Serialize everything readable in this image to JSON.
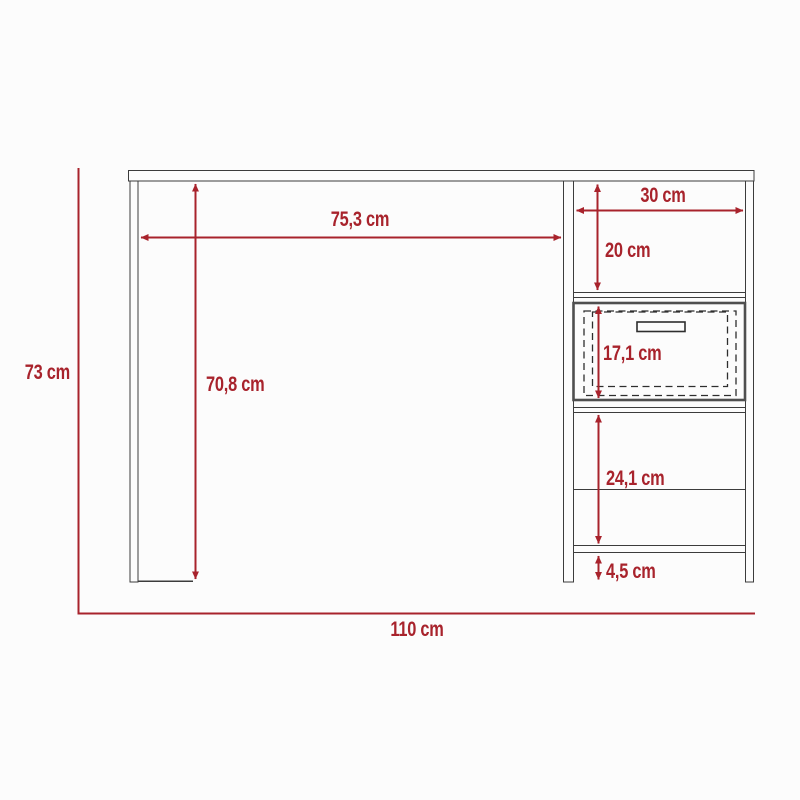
{
  "diagram": {
    "type": "furniture-dimension-drawing",
    "subject": "writing desk with side pedestal, open shelves and one drawer",
    "unit": "cm"
  },
  "colors": {
    "dimension_red": "#a8232c",
    "structure_line": "#3c3c3c",
    "drawer_border": "#4f4f4f",
    "background": "#fcfcfc"
  },
  "dimensions": {
    "overall_height": {
      "label": "73 cm",
      "value": 73
    },
    "overall_width": {
      "label": "110 cm",
      "value": 110
    },
    "worktop_clear_width": {
      "label": "75,3 cm",
      "value": 75.3
    },
    "under_desk_height": {
      "label": "70,8 cm",
      "value": 70.8
    },
    "pedestal_width": {
      "label": "30 cm",
      "value": 30
    },
    "top_compartment_height": {
      "label": "20 cm",
      "value": 20
    },
    "drawer_height": {
      "label": "17,1 cm",
      "value": 17.1
    },
    "lower_compartment_height": {
      "label": "24,1 cm",
      "value": 24.1
    },
    "bottom_clearance": {
      "label": "4,5 cm",
      "value": 4.5
    }
  }
}
